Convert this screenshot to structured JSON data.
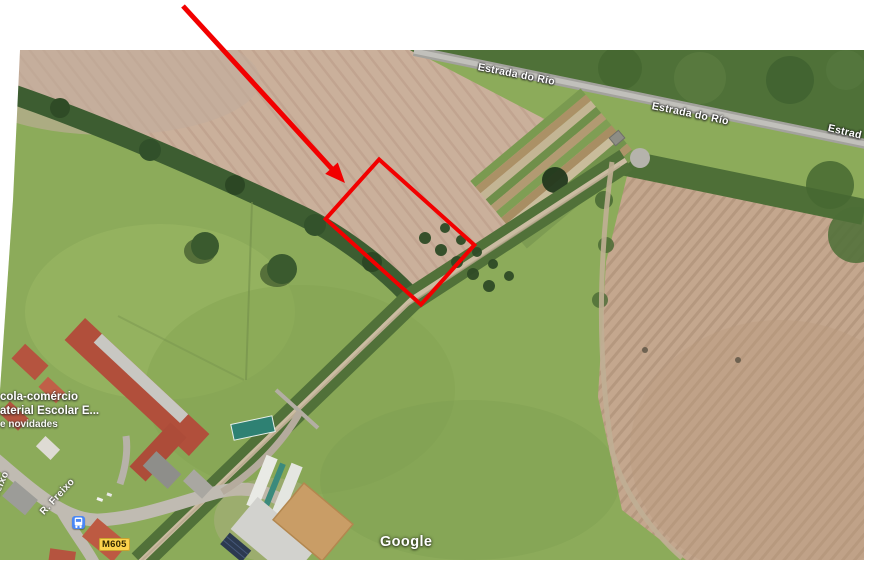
{
  "figure": {
    "kind": "annotated-satellite-screenshot",
    "annotation": "red arrow pointing to red-outlined land parcel"
  },
  "colors": {
    "annotation_red": "#f20000",
    "route_badge_yellow": "#fcd24c",
    "bus_icon_blue": "#4a87f5",
    "map_label_white": "#ffffff"
  },
  "map": {
    "road_labels": [
      "Estrada do Río",
      "Estrada do Río",
      "Estrad"
    ],
    "street_labels": [
      "R. Freixo",
      "R. Freixo"
    ],
    "poi_lines": [
      "cola-comércio",
      "aterial Escolar E...",
      "e novidades"
    ],
    "route_badge": "M605",
    "watermark": "Google",
    "icons": [
      {
        "name": "bus-stop-icon",
        "glyph": "bus"
      }
    ]
  }
}
